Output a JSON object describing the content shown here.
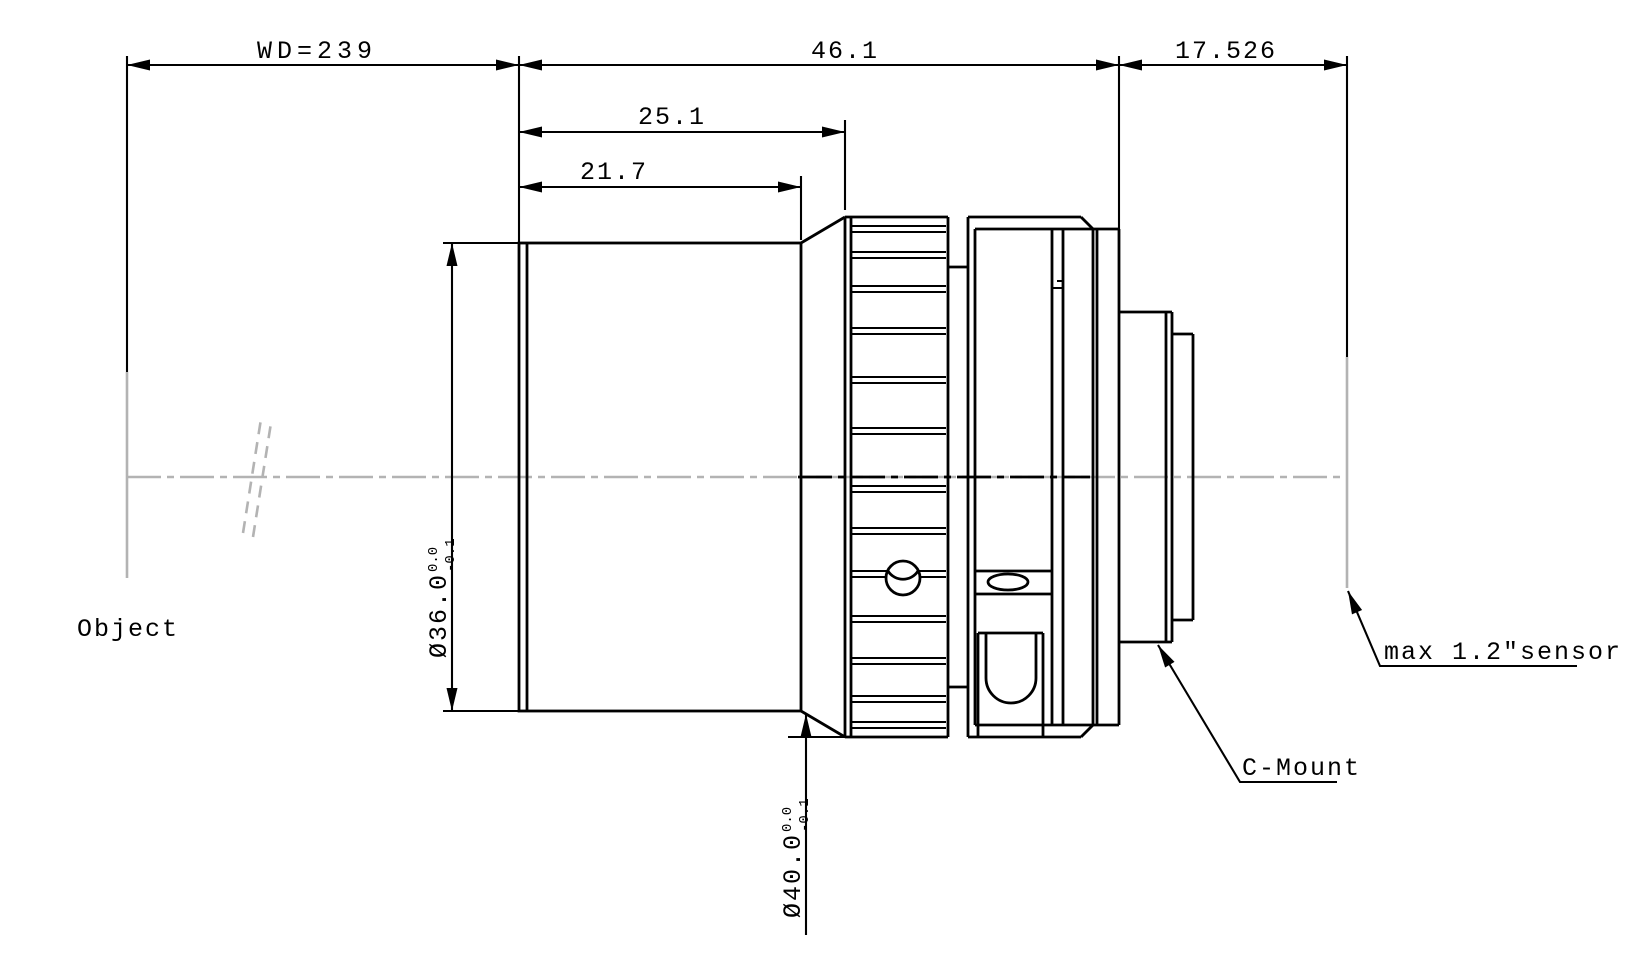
{
  "drawing": {
    "title": "lens-outline-technical-drawing",
    "dimensions": {
      "working_distance": "WD=239",
      "body_length": "46.1",
      "flange_distance": "17.526",
      "front_length": "25.1",
      "barrel_length": "21.7",
      "front_diameter": {
        "value": "Ø36.0",
        "tol_upper": "0.0",
        "tol_lower": "-0.1"
      },
      "ring_diameter": {
        "value": "Ø40.0",
        "tol_upper": "0.0",
        "tol_lower": "-0.1"
      }
    },
    "labels": {
      "object": "Object",
      "c_mount": "C-Mount",
      "sensor": "max 1.2″sensor"
    },
    "colors": {
      "line": "#000000",
      "centerline": "#b3b3b3",
      "background": "#ffffff"
    }
  }
}
